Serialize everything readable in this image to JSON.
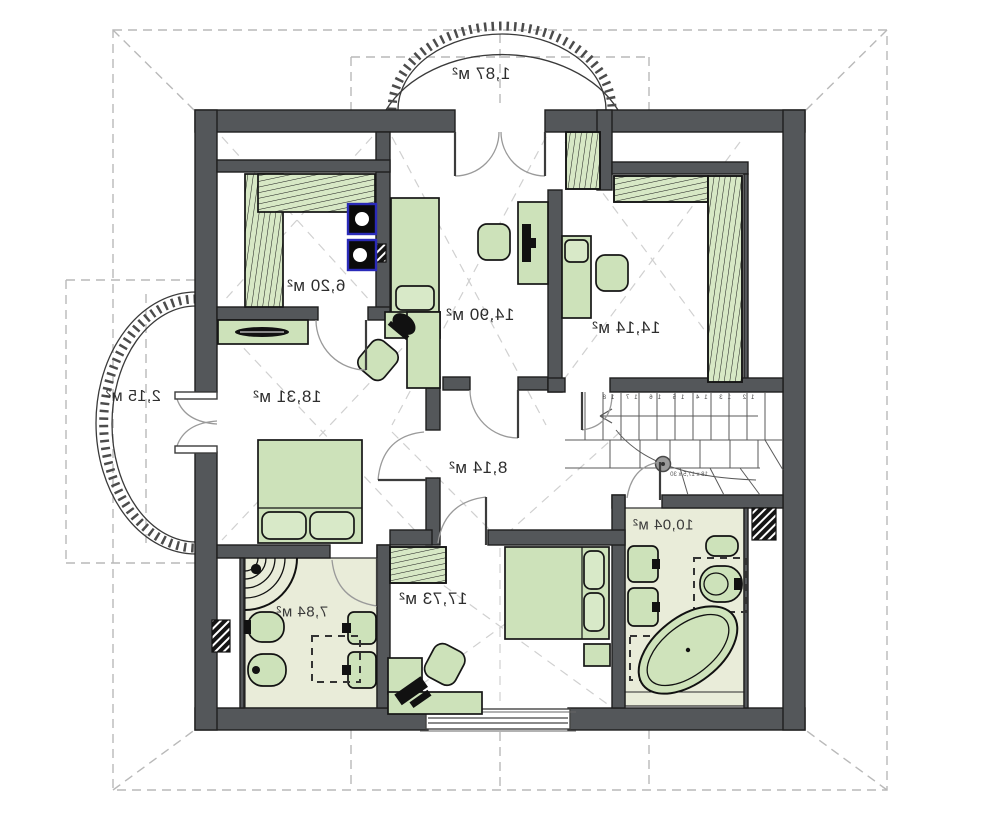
{
  "plan_title": "attic floor plan",
  "rooms": [
    {
      "id": "balcony-top",
      "area": "1,87 м²"
    },
    {
      "id": "wardrobe",
      "area": "6,20 м²"
    },
    {
      "id": "bedroom-top-left",
      "area": "14,90 м²"
    },
    {
      "id": "bedroom-top-right",
      "area": "14,14 м²"
    },
    {
      "id": "balcony-left",
      "area": "2,15 м²"
    },
    {
      "id": "bedroom-left",
      "area": "18,31 м²"
    },
    {
      "id": "hallway",
      "area": "8,14 м²"
    },
    {
      "id": "bathroom-right",
      "area": "10,04 м²"
    },
    {
      "id": "bathroom-left",
      "area": "7,84 м²"
    },
    {
      "id": "bedroom-bottom",
      "area": "17,73 м²"
    }
  ],
  "stairs": {
    "note": "18 x 17,5 x 30",
    "step_numbers": "12 13 14 15 16 17 18"
  },
  "colors": {
    "wall": "#54575a",
    "furniture_green": "#cde2ba",
    "closet_green": "#d7e8c5",
    "bath_floor": "#e9ecd9",
    "appliance_blue": "#2a2ab8",
    "dash_gray": "#bababa"
  }
}
